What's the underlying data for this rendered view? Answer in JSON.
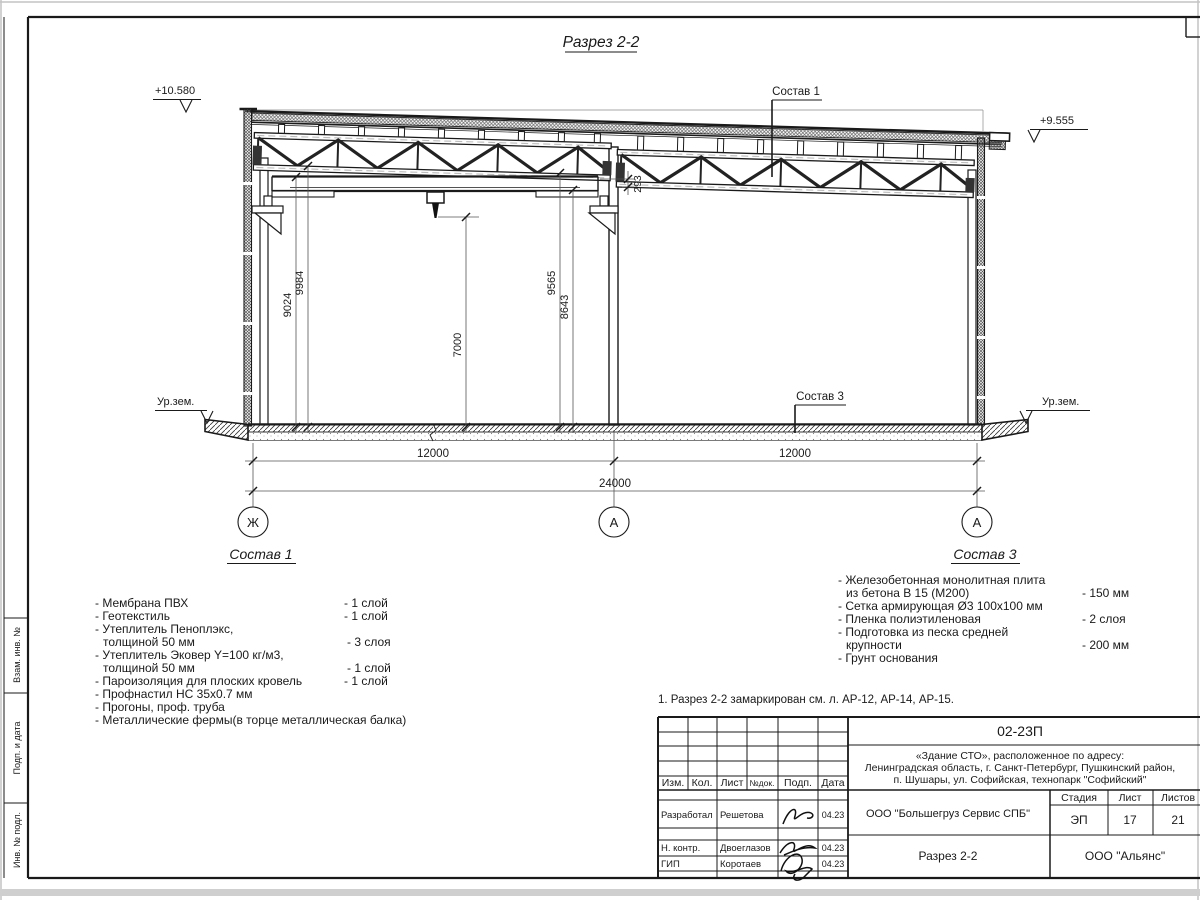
{
  "sheet": {
    "title": "Разрез 2-2",
    "note": "1. Разрез 2-2 замаркирован см. л. АР-12, АР-14, АР-15."
  },
  "drawing": {
    "elev_top_left": "+10.580",
    "elev_top_right": "+9.555",
    "ground_label_left": "Ур.зем.",
    "ground_label_right": "Ур.зем.",
    "leader1": "Состав 1",
    "leader3": "Состав 3",
    "dims": {
      "v9024": "9024",
      "v9984": "9984",
      "v7000": "7000",
      "v9565": "9565",
      "v8643": "8643",
      "v293": "293",
      "bay_left": "12000",
      "bay_right": "12000",
      "total": "24000"
    },
    "axes": {
      "a1": "Ж",
      "a2": "А",
      "a3": "А"
    }
  },
  "sostav1": {
    "title": "Состав 1",
    "lines": [
      {
        "t": "- Мембрана ПВХ",
        "q": "- 1 слой"
      },
      {
        "t": "- Геотекстиль",
        "q": "- 1 слой"
      },
      {
        "t": "- Утеплитель Пеноплэкс,",
        "q": ""
      },
      {
        "t": "толщиной 50 мм",
        "q": "- 3 слоя"
      },
      {
        "t": "- Утеплитель Эковер Y=100 кг/м3,",
        "q": ""
      },
      {
        "t": "толщиной 50 мм",
        "q": "- 1 слой"
      },
      {
        "t": "- Пароизоляция для плоских кровель",
        "q": "- 1 слой"
      },
      {
        "t": "- Профнастил НС 35х0.7 мм",
        "q": ""
      },
      {
        "t": "- Прогоны, проф. труба",
        "q": ""
      },
      {
        "t": "- Металлические фермы(в торце металлическая балка)",
        "q": ""
      }
    ]
  },
  "sostav3": {
    "title": "Состав 3",
    "lines": [
      {
        "t": "- Железобетонная  монолитная плита",
        "q": ""
      },
      {
        "t": "из бетона В 15 (М200)",
        "q": "- 150 мм"
      },
      {
        "t": "- Сетка армирующая Ø3 100x100 мм",
        "q": ""
      },
      {
        "t": "- Пленка полиэтиленовая",
        "q": "-  2 слоя"
      },
      {
        "t": "- Подготовка из песка средней",
        "q": ""
      },
      {
        "t": "крупности",
        "q": "- 200 мм"
      },
      {
        "t": "- Грунт основания",
        "q": ""
      }
    ]
  },
  "titleblock": {
    "doc": "02-23П",
    "addr1": "«Здание СТО», расположенное по адресу:",
    "addr2": "Ленинградская область, г. Санкт-Петербург, Пушкинский район,",
    "addr3": "п. Шушары, ул. Софийская, технопарк \"Софийский\"",
    "col_izm": "Изм.",
    "col_kol": "Кол.",
    "col_list": "Лист",
    "col_doc": "№док.",
    "col_podp": "Подп.",
    "col_data": "Дата",
    "r1_role": "Разработал",
    "r1_name": "Решетова",
    "r1_date": "04.23",
    "r2_role": "Н. контр.",
    "r2_name": "Двоеглазов",
    "r2_date": "04.23",
    "r3_role": "ГИП",
    "r3_name": "Коротаев",
    "r3_date": "04.23",
    "client": "ООО \"Большегруз Сервис СПБ\"",
    "stage_label": "Стадия",
    "list_label": "Лист",
    "listov_label": "Листов",
    "stage": "ЭП",
    "list": "17",
    "listov": "21",
    "sheet_name": "Разрез 2-2",
    "org": "ООО \"Альянс\""
  },
  "frame": {
    "side1": "Взам. инв. №",
    "side2": "Подп. и дата",
    "side3": "Инв. № подл."
  }
}
